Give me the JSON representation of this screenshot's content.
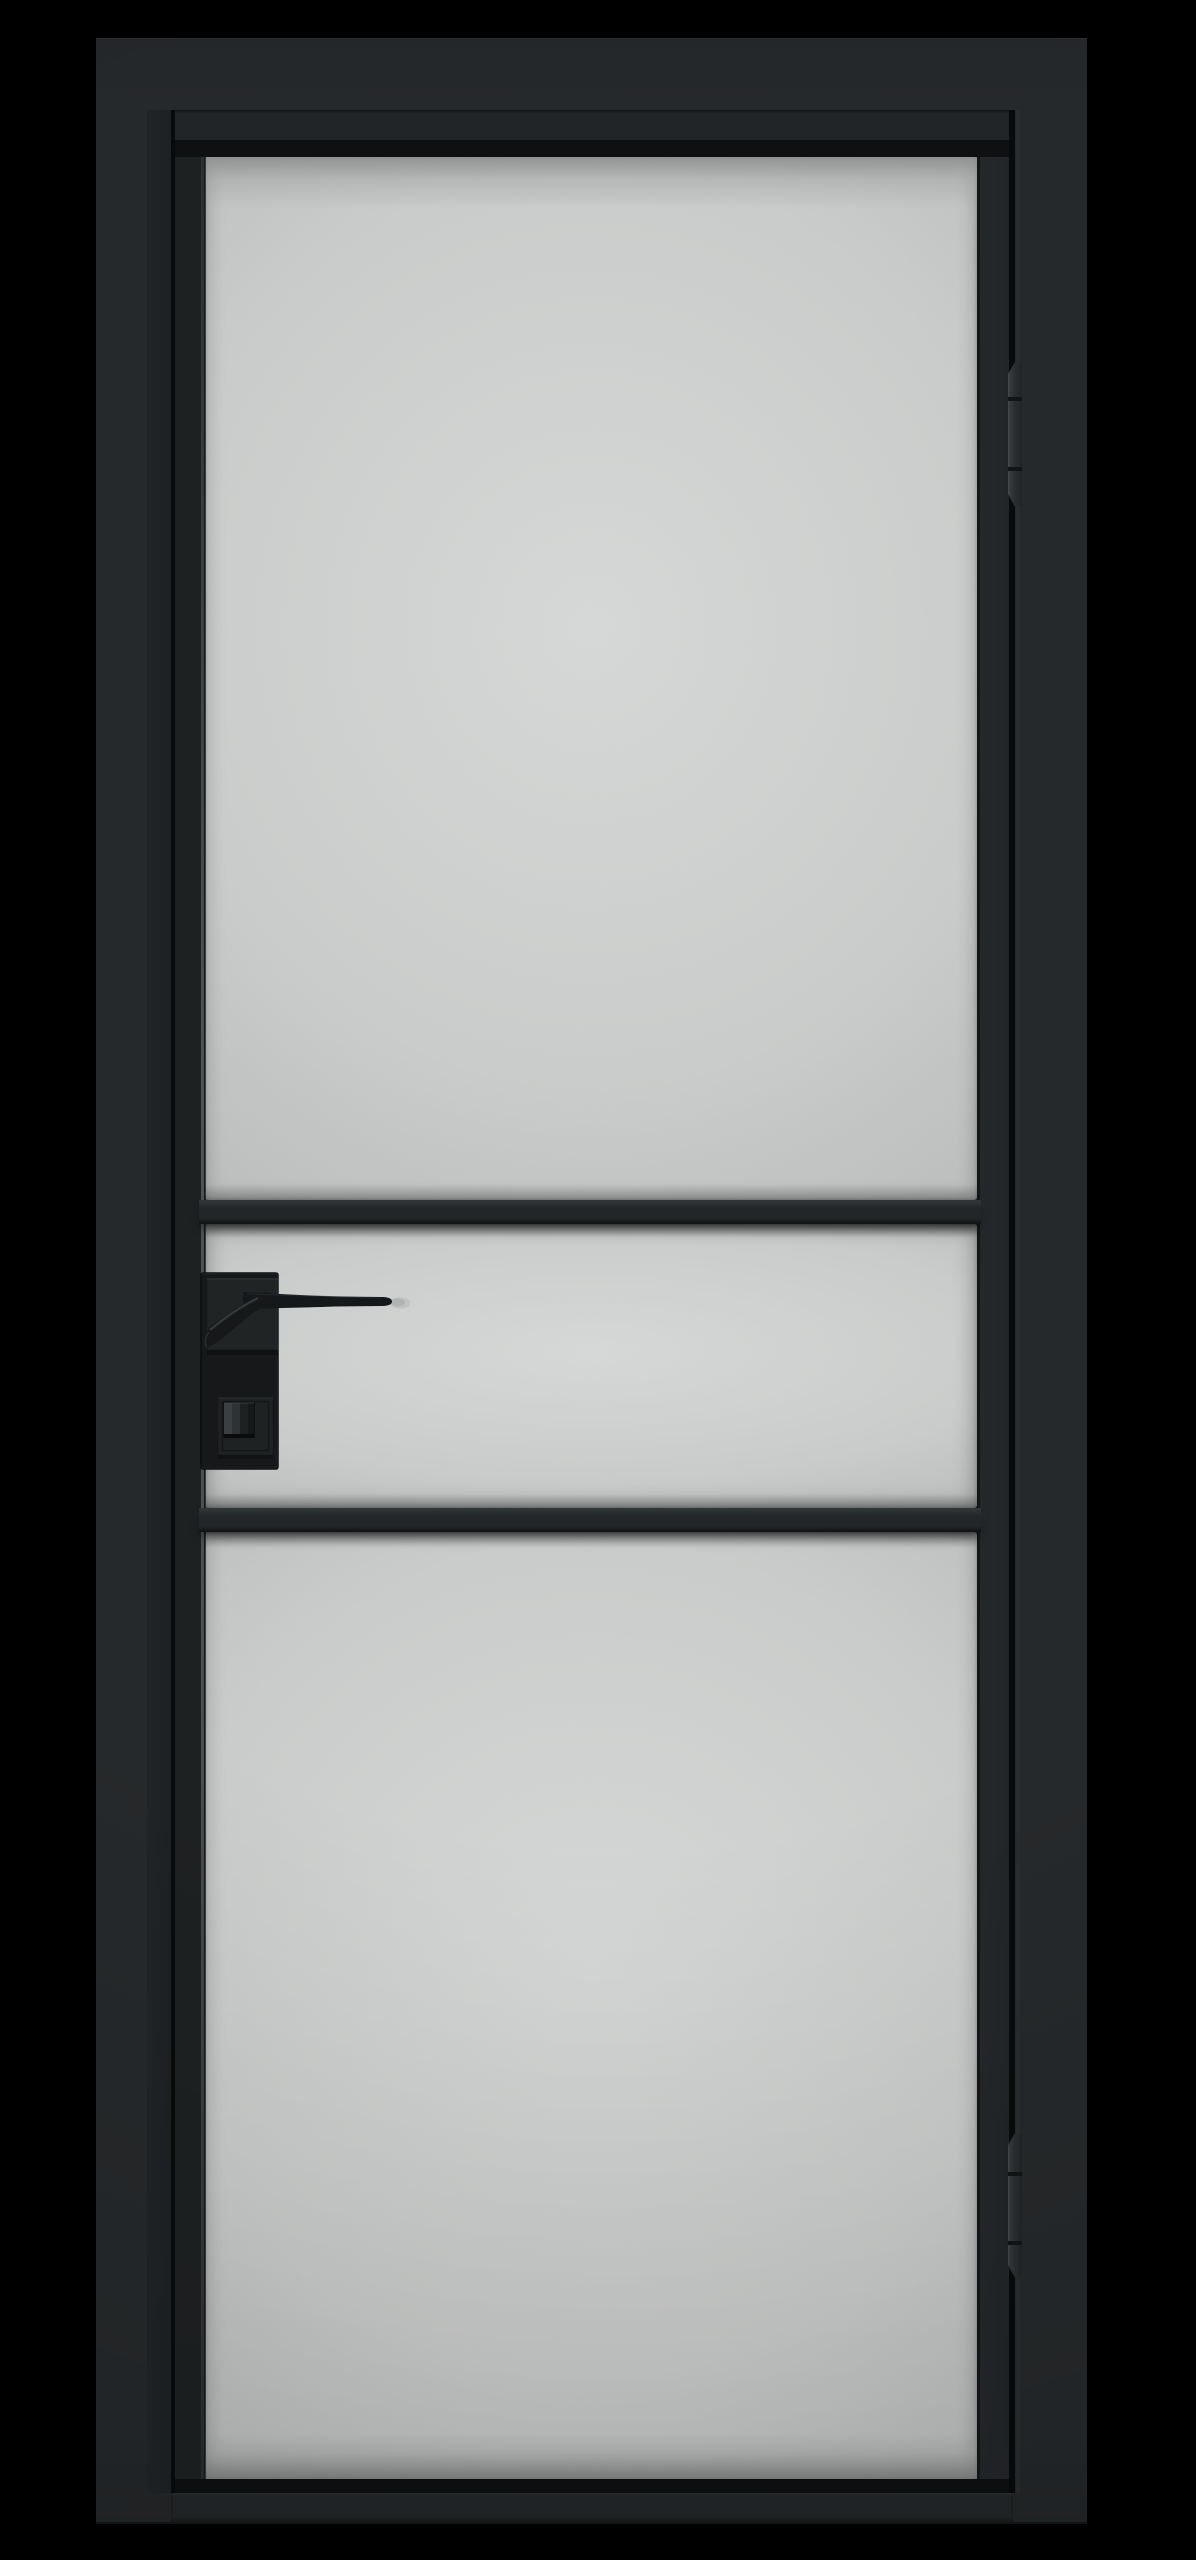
{
  "scene": {
    "title": "Black aluminium loft-style interior door with frosted glass, product render on black background",
    "description": "Front view of a single-leaf interior door: slim black aluminium frame and leaf profiles, three frosted (sandblasted) glass panels separated by two horizontal black mullion bars, a matte black lever handle on a square rosette with a thumbturn lock below it on the left stile, and two black three-knuckle hinges on the right-hand seam between leaf and frame.",
    "object": "single-leaf glazed interior door",
    "style": "loft / industrial, matte black aluminium profile",
    "background": "solid black studio backdrop",
    "view": "straight-on front elevation, slight top perspective on glass bevels"
  },
  "door": {
    "frame": {
      "label": "door frame (jambs and head)",
      "finish": "matte black aluminium",
      "color": "#26292b"
    },
    "leaf": {
      "label": "door leaf with slim stiles and rails",
      "color": "#1e2122"
    },
    "glass": {
      "label": "frosted glass",
      "finish": "frosted / translucent",
      "color": "#cbcdcc",
      "panel_count": 3,
      "panels": [
        "large upper panel",
        "short middle panel at handle height",
        "large lower panel"
      ]
    },
    "mullions": {
      "count": 2,
      "orientation": "horizontal",
      "color": "#232628",
      "position": "above and below the handle zone"
    },
    "handle": {
      "type": "lever handle on square rosette with long backplate",
      "side": "left stile, pointing right",
      "color": "#16181a",
      "parts": [
        "backplate",
        "square rosette",
        "straight lever with angled neck",
        "square lock escutcheon",
        "ridged thumbturn"
      ]
    },
    "hinges": {
      "count": 2,
      "side": "right seam",
      "knuckles_per_hinge": 3,
      "color": "#2e3234",
      "positions": [
        "upper",
        "lower"
      ]
    }
  },
  "colors": {
    "bg": "#000000",
    "frame": "#26292b",
    "frame-reveal": "#212427",
    "frame-hi": "#2e3336",
    "leaf": "#1e2122",
    "leaf-top": "#222528",
    "channel": "#0e1011",
    "stile-right": "#25282b",
    "rail": "#242729",
    "seam": "#090a0b",
    "bar": "#232628",
    "bar-hi": "#303436",
    "bar-lo": "#0f1112",
    "glass": "#cbcdcc",
    "glass-hi": "#d7d9d8",
    "glass-lo": "#b7b9b8",
    "hw": "#16181a",
    "hw-face": "#212426",
    "hw-hi": "#404648",
    "hw-deep": "#0b0c0d",
    "hinge-a": "#3a3f42",
    "hinge-b": "#26292c",
    "hinge-gap": "#121416",
    "tip-shadow": "#8f9291"
  }
}
